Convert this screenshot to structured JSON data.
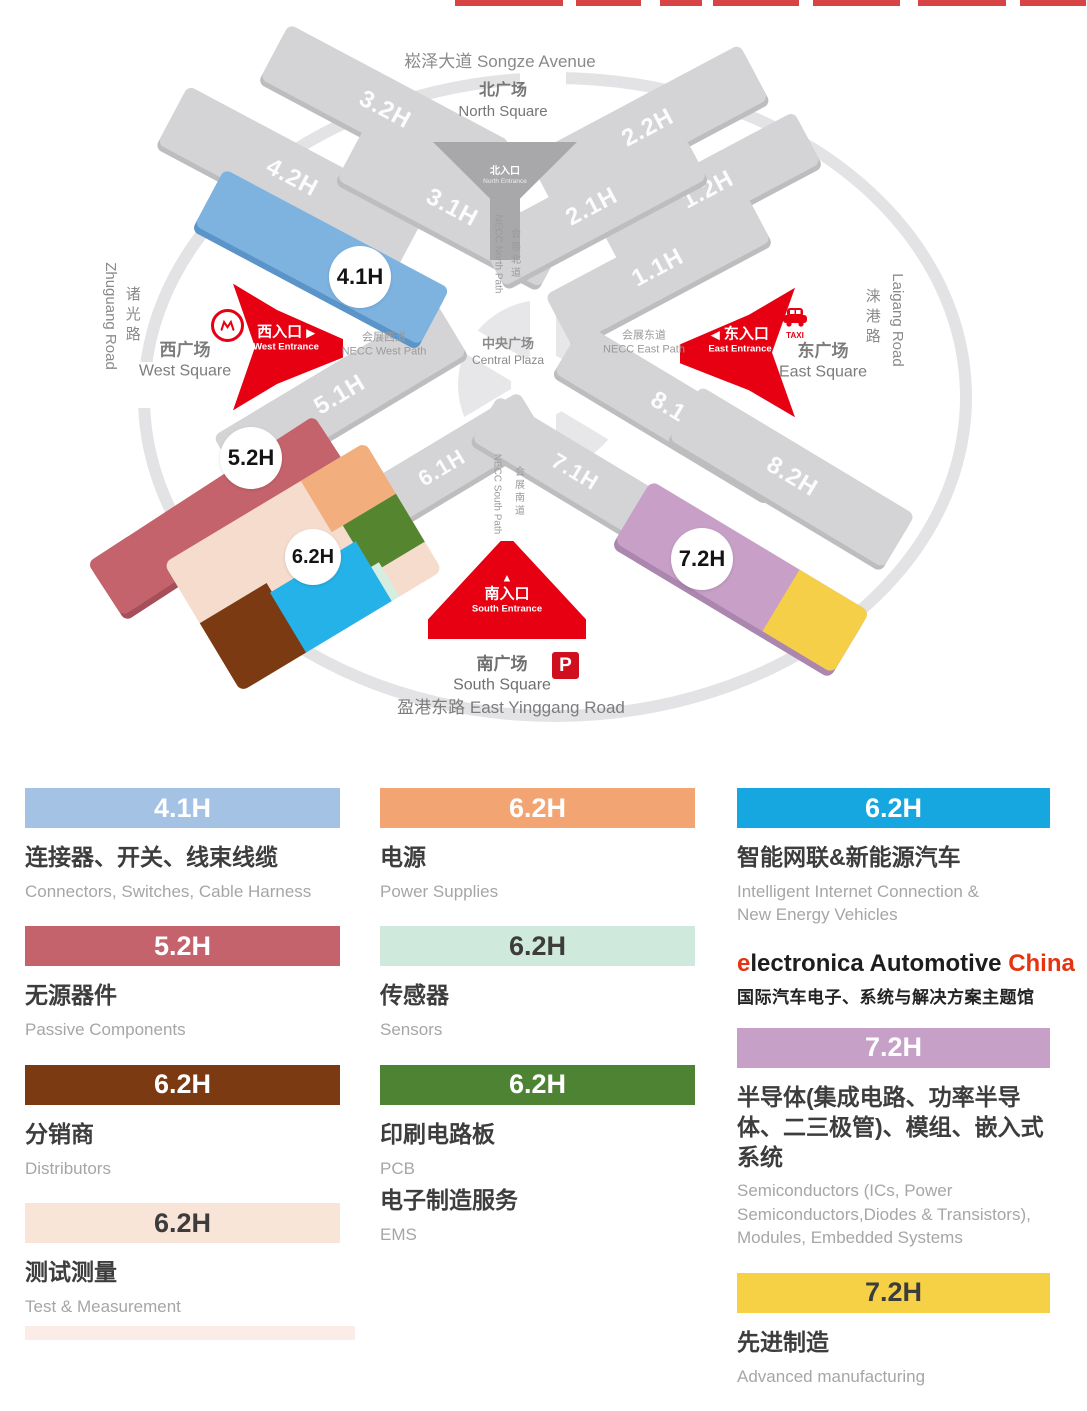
{
  "map": {
    "songze_avenue": "崧泽大道 Songze Avenue",
    "north_square_zh": "北广场",
    "north_square_en": "North Square",
    "west_square_zh": "西广场",
    "west_square_en": "West Square",
    "east_square_zh": "东广场",
    "east_square_en": "East Square",
    "south_square_zh": "南广场",
    "south_square_en": "South Square",
    "yinggang_road": "盈港东路 East Yinggang Road",
    "zhuguang_zh": "诸光路",
    "zhuguang_en": "Zhuguang Road",
    "laigang_zh": "涞港路",
    "laigang_en": "Laigang Road",
    "central_plaza_zh": "中央广场",
    "central_plaza_en": "Central Plaza",
    "north_path_zh": "会展北道",
    "north_path_en": "NECC North Path",
    "south_path_zh": "会展南道",
    "south_path_en": "NECC South Path",
    "west_path_zh": "会展西道",
    "west_path_en": "NECC West Path",
    "east_path_zh": "会展东道",
    "east_path_en": "NECC East Path",
    "entrance_north_zh": "北入口",
    "entrance_north_en": "North Entrance",
    "entrance_west_zh": "西入口",
    "entrance_west_en": "West Entrance",
    "entrance_east_zh": "东入口",
    "entrance_east_en": "East Entrance",
    "entrance_south_zh": "南入口",
    "entrance_south_en": "South Entrance",
    "taxi": "TAXI",
    "parking": "P",
    "arrow_right": "▶",
    "arrow_left": "◀",
    "arrow_up": "▲",
    "halls": {
      "g32": "3.2H",
      "g22": "2.2H",
      "g42": "4.2H",
      "g31": "3.1H",
      "g21": "2.1H",
      "g12": "1.2H",
      "g11": "1.1H",
      "g51": "5.1H",
      "g81": "8.1H",
      "g61": "6.1H",
      "g71": "7.1H",
      "g82": "8.2H"
    },
    "badges": {
      "b41": "4.1H",
      "b52": "5.2H",
      "b62": "6.2H",
      "b72": "7.2H"
    }
  },
  "legend": {
    "items": [
      {
        "hall": "4.1H",
        "zh": "连接器、开关、线束线缆",
        "en": "Connectors, Switches, Cable Harness",
        "color": "#a3c2e4"
      },
      {
        "hall": "5.2H",
        "zh": "无源器件",
        "en": "Passive Components",
        "color": "#c5636d"
      },
      {
        "hall": "6.2H",
        "zh": "分销商",
        "en": "Distributors",
        "color": "#7c3a12"
      },
      {
        "hall": "6.2H",
        "zh": "测试测量",
        "en": "Test & Measurement",
        "color": "#f9e4d8"
      },
      {
        "hall": "6.2H",
        "zh": "电源",
        "en": "Power Supplies",
        "color": "#f2a572"
      },
      {
        "hall": "6.2H",
        "zh": "传感器",
        "en": "Sensors",
        "color": "#cfe9dc"
      },
      {
        "hall": "6.2H",
        "zh": "印刷电路板",
        "en": "PCB",
        "zh2": "电子制造服务",
        "en2": "EMS",
        "color": "#4e8334"
      },
      {
        "hall": "6.2H",
        "zh": "智能网联&新能源汽车",
        "en": "Intelligent Internet Connection &",
        "en2": "New Energy Vehicles",
        "color": "#16a7e0"
      },
      {
        "hall": "7.2H",
        "zh": "半导体(集成电路、功率半导体、二三极管)、模组、嵌入式系统",
        "en": "Semiconductors (ICs, Power Semiconductors,Diodes & Transistors), Modules, Embedded Systems",
        "color": "#c7a0c8"
      },
      {
        "hall": "7.2H",
        "zh": "先进制造",
        "en": "Advanced manufacturing",
        "color": "#f7d145"
      }
    ],
    "brand": {
      "prefix": "e",
      "name": "lectronica Automotive",
      "suffix": "China",
      "tagline": "国际汽车电子、系统与解决方案主题馆"
    }
  },
  "colors": {
    "entrance_red": "#e60012",
    "gray_hall": "#d4d4d6",
    "blue_hall": "#7eb3e0",
    "rose_hall": "#c4636b",
    "lavender_hall": "#c79fc7",
    "yellow_hall": "#f6cf49",
    "pink_62": "#f5dccd",
    "orange_62": "#f3ae7d",
    "green_62": "#55862f",
    "mint_62": "#d5eee1",
    "brown_62": "#7b3a11",
    "cyan_62": "#25b2e8"
  }
}
